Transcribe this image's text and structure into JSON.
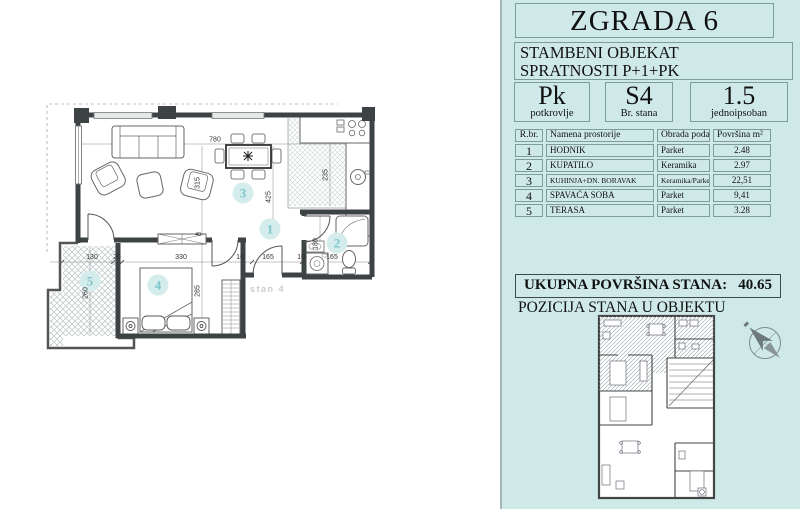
{
  "colors": {
    "panel_bg": "#cfe9e9",
    "panel_border": "#7d9d9d",
    "wall": "#3d4245",
    "room_number": "#7fc6cb",
    "hatch": "#b8c6c6"
  },
  "panel": {
    "title": "ZGRADA 6",
    "subtitle_line1": "STAMBENI OBJEKAT",
    "subtitle_line2": "SPRATNOSTI P+1+PK",
    "info_boxes": [
      {
        "value": "Pk",
        "label": "potkrovlje"
      },
      {
        "value": "S4",
        "label": "Br. stana"
      },
      {
        "value": "1.5",
        "label": "jednoipsoban"
      }
    ],
    "table": {
      "headers": {
        "num": "R.br.",
        "name": "Namena prostorije",
        "floor": "Obrada poda",
        "area": "Površina  m²"
      },
      "rows": [
        {
          "num": "1",
          "name": "HODNIK",
          "floor": "Parket",
          "area": "2.48"
        },
        {
          "num": "2",
          "name": "KUPATILO",
          "floor": "Keramika",
          "area": "2.97"
        },
        {
          "num": "3",
          "name": "KUHINJA+DN. BORAVAK",
          "floor": "Keramika/Parket",
          "area": "22,51"
        },
        {
          "num": "4",
          "name": "SPAVAĆA SOBA",
          "floor": "Parket",
          "area": "9,41"
        },
        {
          "num": "5",
          "name": "TERASA",
          "floor": "Parket",
          "area": "3.28"
        }
      ]
    },
    "total_label": "UKUPNA POVRŠINA STANA:",
    "total_value": "40.65",
    "position_label": "POZICIJA STANA  U OBJEKTU"
  },
  "plan": {
    "apartment_label": "stan 4",
    "room_numbers": {
      "hall": "1",
      "bath": "2",
      "living": "3",
      "bedroom": "4",
      "terrace": "5"
    },
    "dims": {
      "top_width": "780",
      "living_height": "425",
      "kitchen_depth": "235",
      "living_left": "315",
      "bedroom_height": "285",
      "terrace_height": "260",
      "bath_height": "180",
      "terrace_width": "130",
      "wall20": "20",
      "bedroom_width": "330",
      "wall10a": "10",
      "hall_width": "165",
      "wall10b": "10",
      "bath_width": "165",
      "door40": "40"
    }
  }
}
